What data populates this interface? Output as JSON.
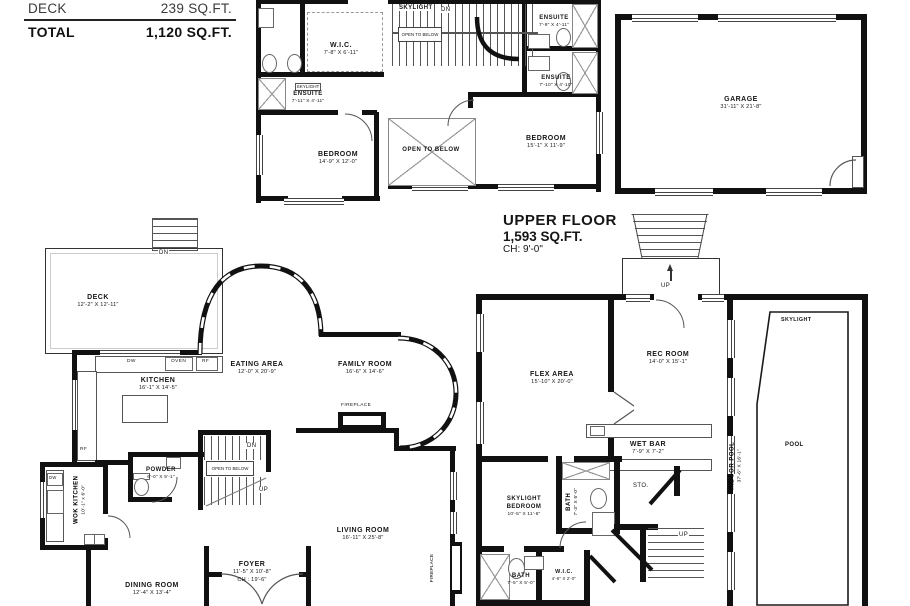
{
  "summary": {
    "rows": [
      {
        "label": "DECK",
        "value": "239 SQ.FT."
      },
      {
        "label": "TOTAL",
        "value": "1,120 SQ.FT."
      }
    ]
  },
  "floor_title": {
    "name": "UPPER FLOOR",
    "area": "1,593 SQ.FT.",
    "ch": "CH: 9'-0\""
  },
  "upper": {
    "skylight": "SKYLIGHT",
    "dn": "DN",
    "open_below_box": "OPEN TO BELOW",
    "open_below": "OPEN TO BELOW",
    "wic": {
      "name": "W.I.C.",
      "dims": "7'-8\" X 6'-11\""
    },
    "skylight_ensuite": {
      "tag": "SKYLIGHT",
      "name": "ENSUITE",
      "dims": "7'-11\" X 4'-11\""
    },
    "bedroom1": {
      "name": "BEDROOM",
      "dims": "14'-9\" X 12'-0\""
    },
    "ensuite1": {
      "name": "ENSUITE",
      "dims": "7'-9\" X 4'-11\""
    },
    "ensuite2": {
      "name": "ENSUITE",
      "dims": "7'-10\" X 4'-10\""
    },
    "bedroom2": {
      "name": "BEDROOM",
      "dims": "15'-1\" X 11'-9\""
    },
    "garage": {
      "name": "GARAGE",
      "dims": "31'-11\" X 21'-8\""
    }
  },
  "entry": {
    "up": "UP"
  },
  "main": {
    "deck": {
      "name": "DECK",
      "dims": "12'-2\" X 12'-11\""
    },
    "deck_dn": "DN",
    "eating": {
      "name": "EATING AREA",
      "dims": "12'-0\" X 20'-9\""
    },
    "kitchen": {
      "name": "KITCHEN",
      "dims": "16'-1\" X 14'-5\""
    },
    "family": {
      "name": "FAMILY ROOM",
      "dims": "16'-6\" X 14'-6\""
    },
    "fireplace": "FIREPLACE",
    "dw": "DW",
    "oven": "OVEN",
    "rf": "RF",
    "rf2": "RF",
    "wok_dw": "DW",
    "wok": {
      "name": "WOK KITCHEN",
      "dims": "10'-1\" x 6'-0\""
    },
    "powder": {
      "name": "POWDER",
      "dims": "6'-0\" X 5'-1\""
    },
    "stair_dn": "DN",
    "stair_up": "UP",
    "open_below_box": "OPEN TO BELOW",
    "living": {
      "name": "LIVING ROOM",
      "dims": "16'-11\" X 25'-8\""
    },
    "foyer": {
      "name": "FOYER",
      "dims": "11'-5\" X 10'-8\"",
      "ch": "CH : 19'-6\""
    },
    "dining": {
      "name": "DINING ROOM",
      "dims": "12'-4\" X 13'-4\""
    },
    "fireplace2": "FIREPLACE"
  },
  "lower": {
    "flex": {
      "name": "FLEX AREA",
      "dims": "15'-10\" X 20'-0\""
    },
    "rec": {
      "name": "REC ROOM",
      "dims": "14'-0\" X 15'-1\""
    },
    "wetbar": {
      "name": "WET BAR",
      "dims": "7'-9\" X 7'-2\""
    },
    "sto": "STO.",
    "bath1": {
      "name": "BATH",
      "dims": "7'-3\" X 5'-0\""
    },
    "bedroom": {
      "line1": "SKYLIGHT",
      "line2": "BEDROOM",
      "dims": "10'-5\" X 11'-6\""
    },
    "bath2": {
      "name": "BATH",
      "dims": "7'-5\" X 5'-0\""
    },
    "wic": {
      "name": "W.I.C.",
      "dims": "4'-6\" X 2'-0\""
    },
    "stair_up": "UP",
    "pool_band": {
      "name": "INDOOR POOL",
      "dims": "37'-6\" X 16'-1\""
    },
    "pool_skylight": "SKYLIGHT",
    "pool": "POOL"
  }
}
